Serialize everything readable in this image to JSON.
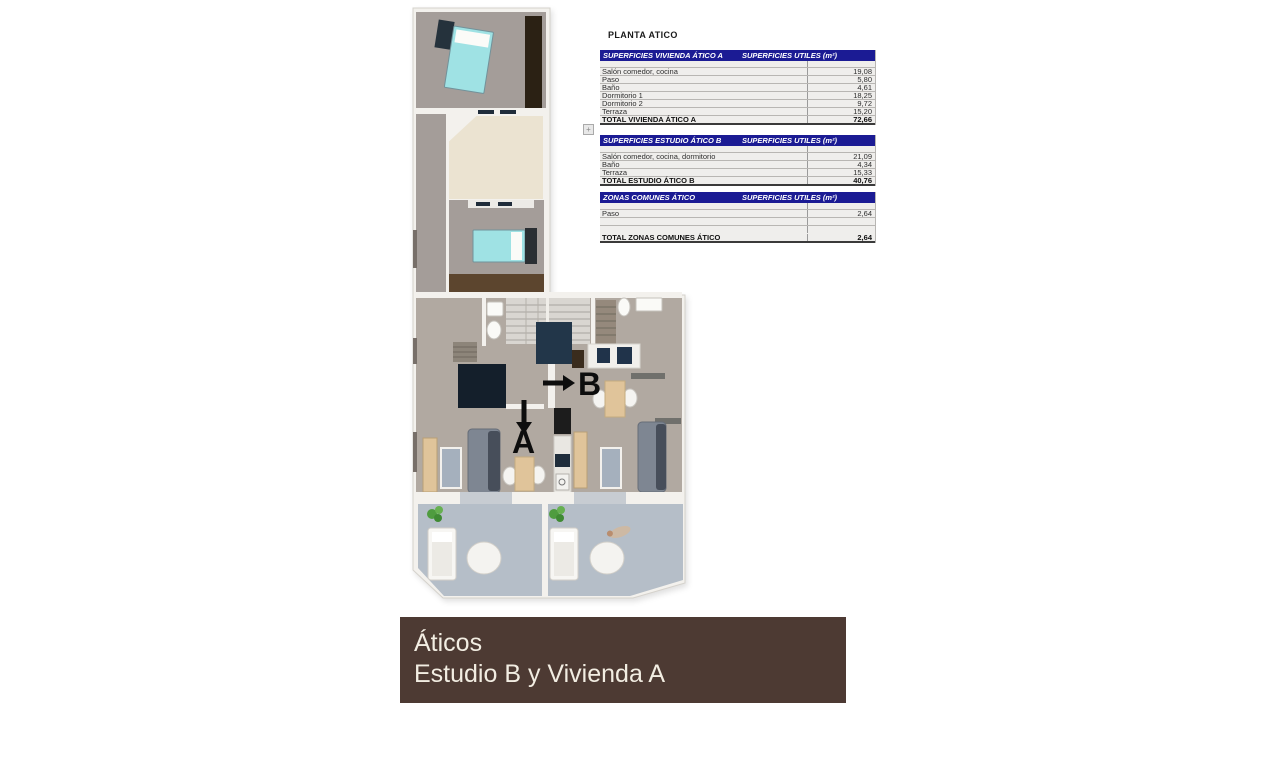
{
  "colors": {
    "banner_bg": "#4d3a33",
    "banner_fg": "#f2ede2",
    "table_header_bg": "#1b1b94",
    "table_header_fg": "#ffffff",
    "bed": "#9fe2e4",
    "navy_rug": "#141f2b",
    "carpet": "#a49d99",
    "floor": "#b1a9a1",
    "terrace_cream": "#ebe3d1",
    "terrace_blue": "#b5bec8",
    "wood": "#5c452e",
    "tan": "#e0c49a",
    "sofa": "#7e8692",
    "wall": "#f3f1ed",
    "plant": "#4f9c3f",
    "arrow": "#0d0d0d"
  },
  "plan": {
    "label_a": "A",
    "label_b": "B"
  },
  "tables_panel": {
    "title": "PLANTA ATICO",
    "tables": [
      {
        "header_left": "SUPERFICIES VIVIENDA ÁTICO A",
        "header_right": "SUPERFICIES UTILES  (m²)",
        "rows": [
          {
            "label": "Salón comedor, cocina",
            "value": "19,08"
          },
          {
            "label": "Paso",
            "value": "5,80"
          },
          {
            "label": "Baño",
            "value": "4,61"
          },
          {
            "label": "Dormitorio 1",
            "value": "18,25"
          },
          {
            "label": "Dormitorio 2",
            "value": "9,72"
          },
          {
            "label": "Terraza",
            "value": "15,20"
          }
        ],
        "total": {
          "label": "TOTAL VIVIENDA ÁTICO A",
          "value": "72,66"
        }
      },
      {
        "header_left": "SUPERFICIES ESTUDIO ÁTICO B",
        "header_right": "SUPERFICIES UTILES  (m²)",
        "rows": [
          {
            "label": "Salón comedor, cocina, dormitorio",
            "value": "21,09"
          },
          {
            "label": "Baño",
            "value": "4,34"
          },
          {
            "label": "Terraza",
            "value": "15,33"
          }
        ],
        "total": {
          "label": "TOTAL ESTUDIO ÁTICO B",
          "value": "40,76"
        }
      },
      {
        "header_left": "ZONAS COMUNES ÁTICO",
        "header_right": "SUPERFICIES UTILES  (m²)",
        "rows": [
          {
            "label": "Paso",
            "value": "2,64"
          },
          {
            "label": "",
            "value": ""
          },
          {
            "label": "",
            "value": ""
          }
        ],
        "total": {
          "label": "TOTAL ZONAS COMUNES ÁTICO",
          "value": "2,64"
        }
      }
    ]
  },
  "banner": {
    "line1": "Áticos",
    "line2": "Estudio B y Vivienda A"
  }
}
